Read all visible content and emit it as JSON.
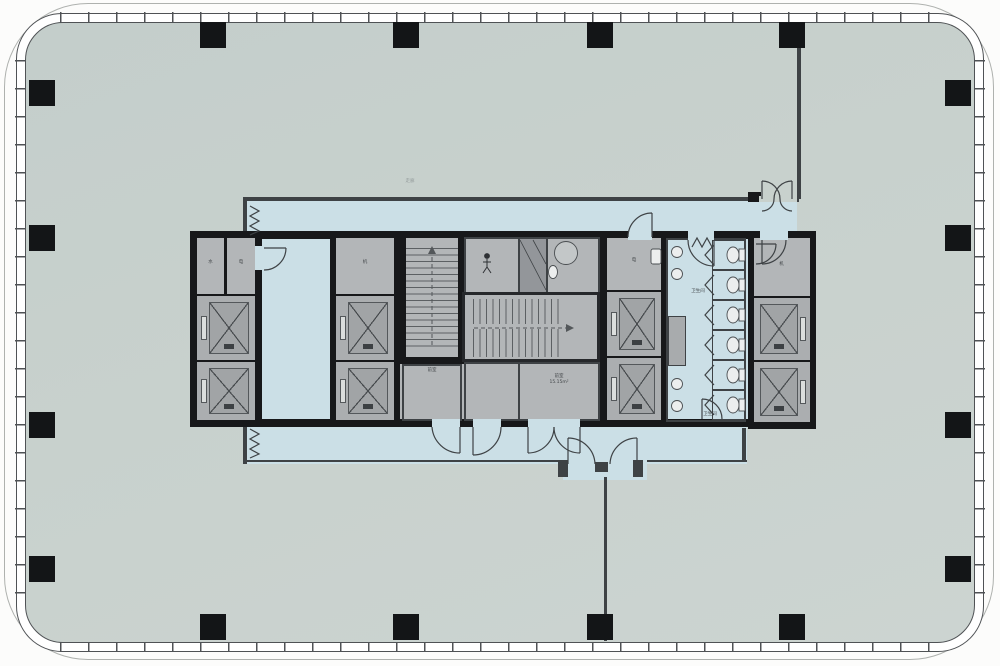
{
  "title": "Office tower typical floor plan",
  "palette": {
    "background": "#fcfcfb",
    "floor_slab": "#c8d1cd",
    "corridor": "#cbdfe6",
    "core_room": "#b3b6b8",
    "core_wall": "#17181a",
    "partition_wall": "#3e4245",
    "column": "#131517",
    "glazing_line": "#4f5255",
    "outer_boundary": "#aeb1ae",
    "elevator_cab": "#a1a4a6",
    "fixture": "#eceeee"
  },
  "building": {
    "outline": "rounded-rectangle curtain wall with mullion ticks",
    "mullion_spacing_px": 28,
    "column_size_px": 26,
    "columns": {
      "top_x": [
        200,
        393,
        587,
        779
      ],
      "bottom_x": [
        200,
        393,
        587,
        779
      ],
      "left_y": [
        80,
        225,
        412,
        556
      ],
      "right_y": [
        80,
        225,
        412,
        556
      ]
    }
  },
  "core": {
    "elevator_banks": [
      {
        "id": "west",
        "elevators": 2
      },
      {
        "id": "mid-west",
        "elevators": 2
      },
      {
        "id": "mid-east",
        "elevators": 2
      },
      {
        "id": "east",
        "elevators": 2
      }
    ],
    "stairs": [
      {
        "id": "stair-1"
      },
      {
        "id": "stair-2"
      }
    ],
    "restroom": {
      "stalls": 6,
      "urinals": 4,
      "accessible_wc": 1
    }
  },
  "labels": {
    "svc_a": "水",
    "svc_b": "电",
    "svc_c": "机",
    "svc_d": "电",
    "svc_e": "机",
    "ante": "前室",
    "room_b_name": "前室",
    "room_b_area": "15.15m²",
    "restroom": "卫生间",
    "restroom2": "卫生间",
    "corridor": "走廊"
  }
}
